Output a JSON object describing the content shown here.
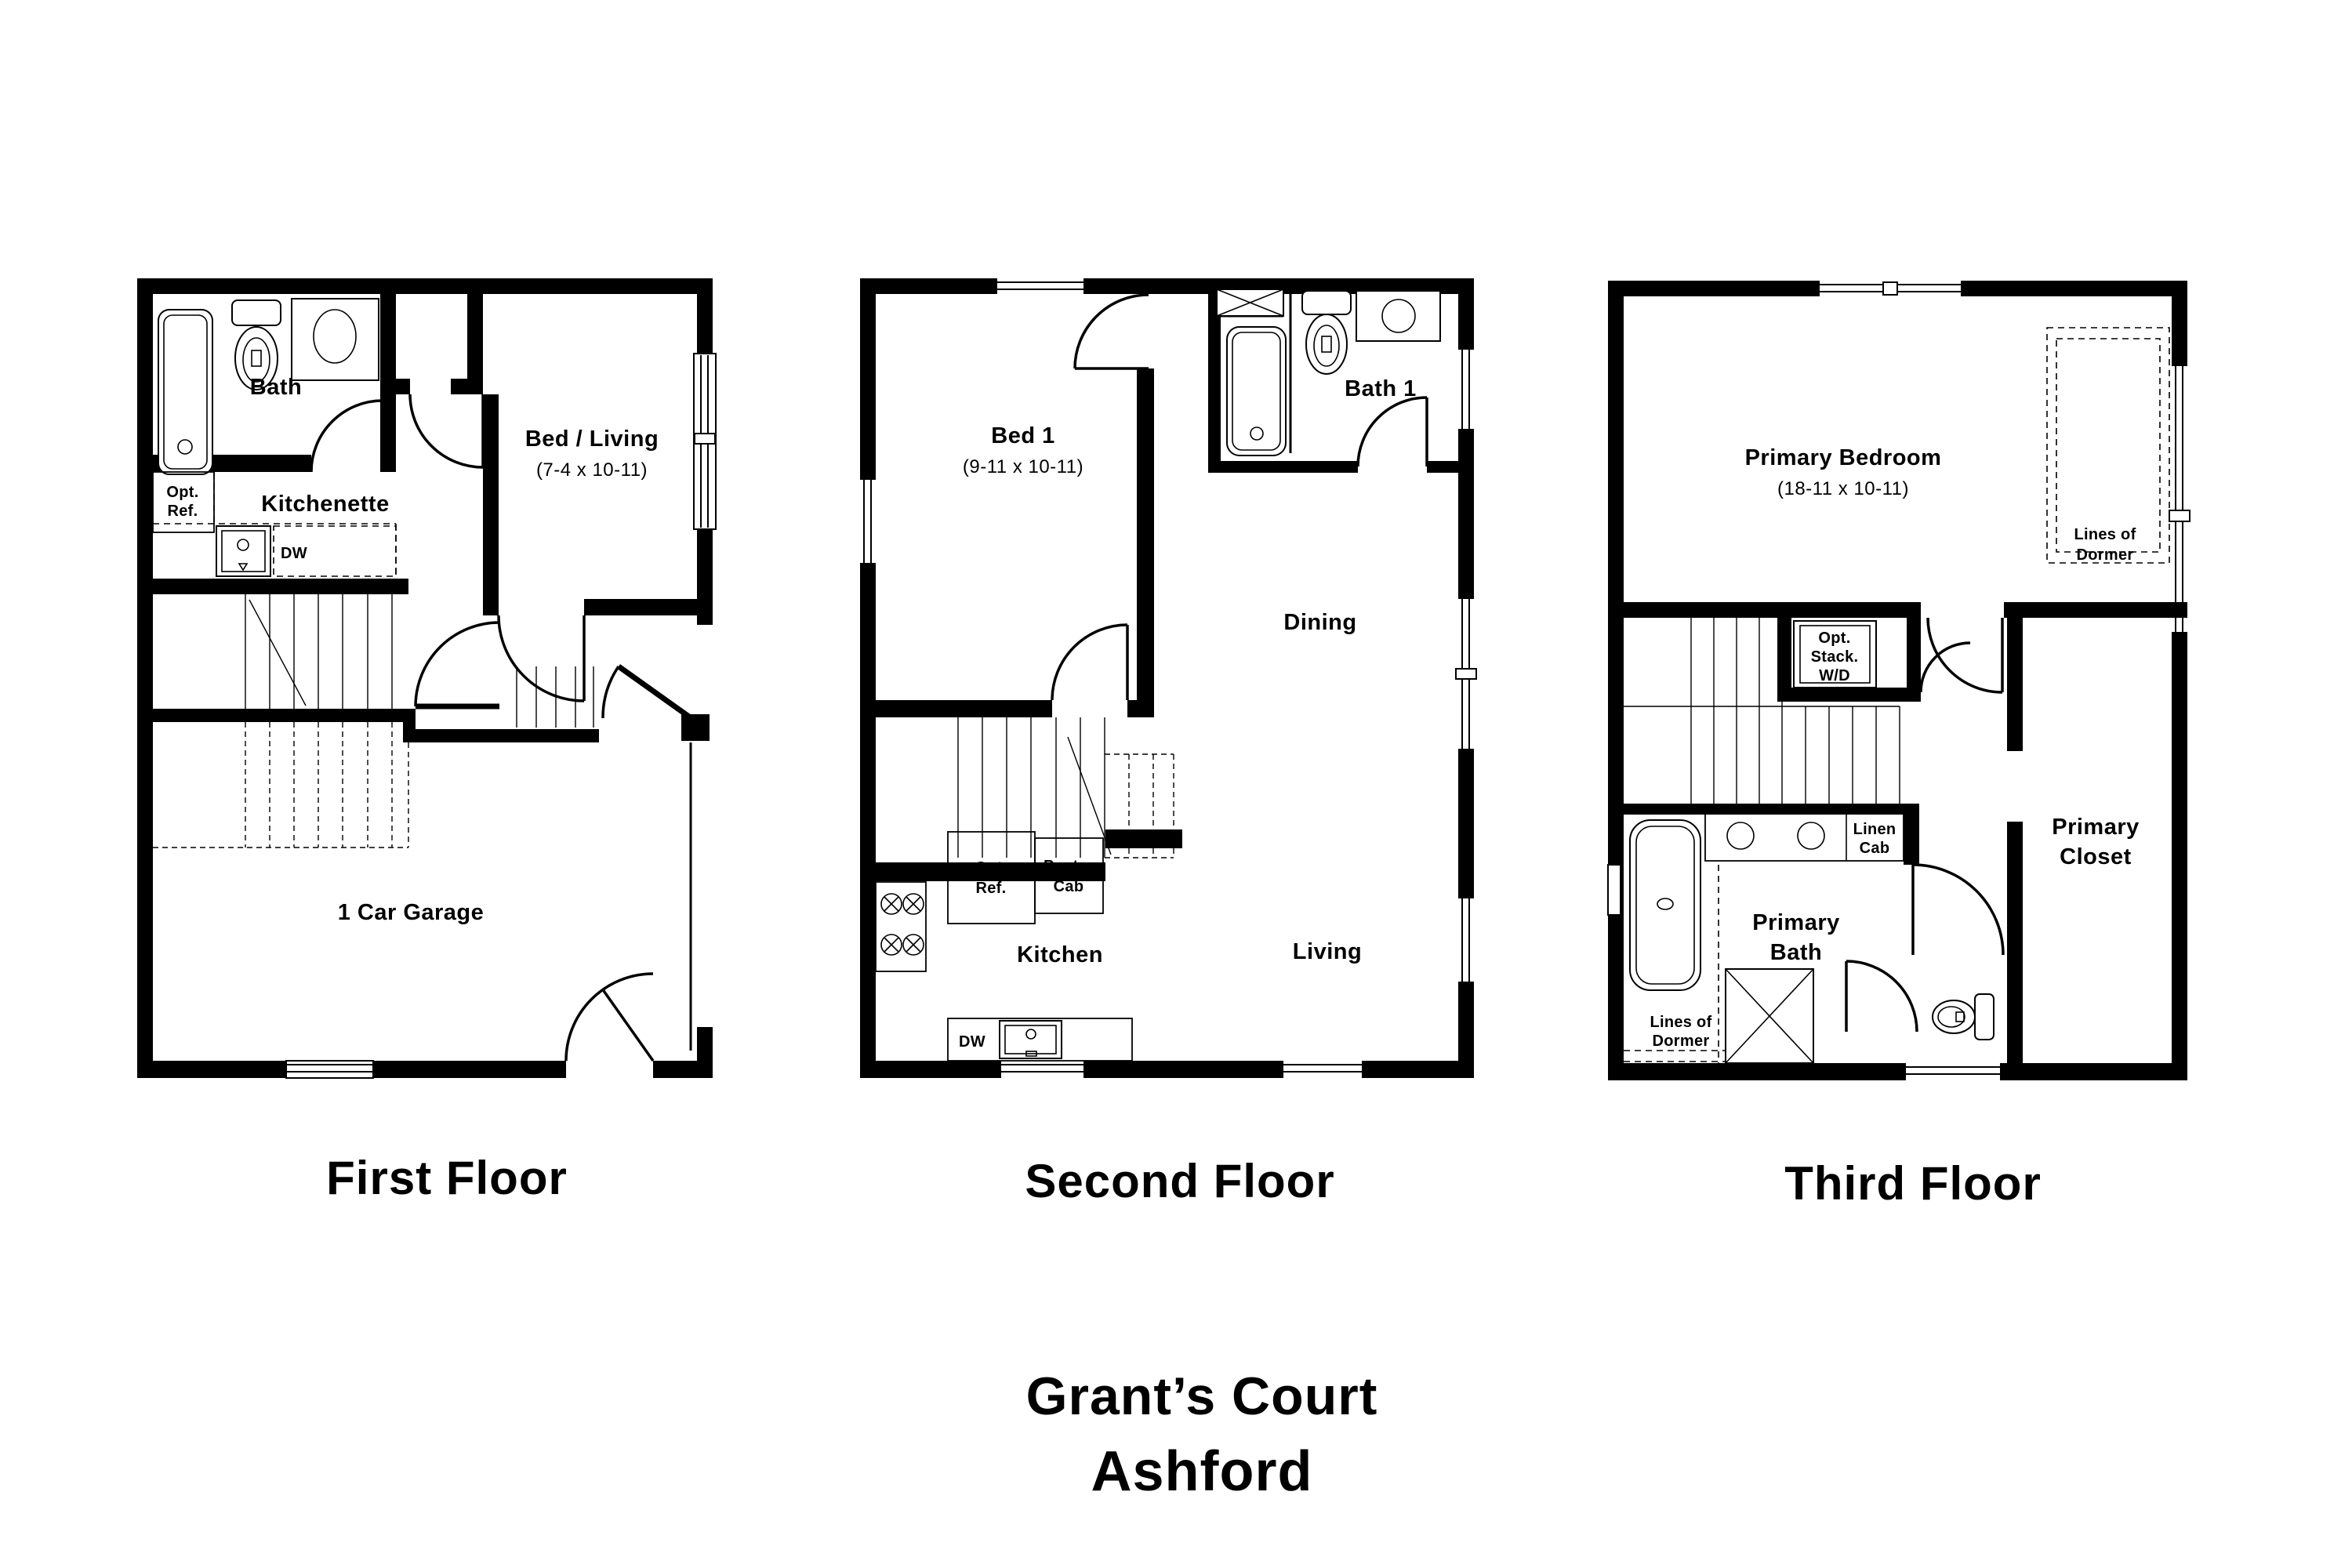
{
  "colors": {
    "ink": "#000000",
    "paper": "#ffffff"
  },
  "title": {
    "community": "Grant’s Court",
    "plan_name": "Ashford"
  },
  "floors": [
    {
      "caption": "First Floor",
      "labels": {
        "bath": "Bath",
        "opt_ref": [
          "Opt.",
          "Ref."
        ],
        "kitchenette": "Kitchenette",
        "bed_living": "Bed / Living",
        "bed_living_dims": "(7-4 x 10-11)",
        "dw": "DW",
        "garage": "1 Car Garage"
      }
    },
    {
      "caption": "Second Floor",
      "labels": {
        "bed1": "Bed 1",
        "bed1_dims": "(9-11 x 10-11)",
        "bath1": "Bath 1",
        "dining": "Dining",
        "opt_ref": [
          "Opt.",
          "Ref."
        ],
        "pantry_cab": [
          "Pantry",
          "Cab"
        ],
        "kitchen": "Kitchen",
        "dw": "DW",
        "living": "Living"
      }
    },
    {
      "caption": "Third Floor",
      "labels": {
        "primary_bedroom": "Primary Bedroom",
        "primary_bedroom_dims": "(18-11 x 10-11)",
        "lines_of_dormer_right": [
          "Lines of",
          "Dormer"
        ],
        "opt_stack_wd": [
          "Opt.",
          "Stack.",
          "W/D"
        ],
        "linen_cab": [
          "Linen",
          "Cab"
        ],
        "primary_bath": [
          "Primary",
          "Bath"
        ],
        "lines_of_dormer_left": [
          "Lines of",
          "Dormer"
        ],
        "primary_closet": [
          "Primary",
          "Closet"
        ]
      }
    }
  ]
}
